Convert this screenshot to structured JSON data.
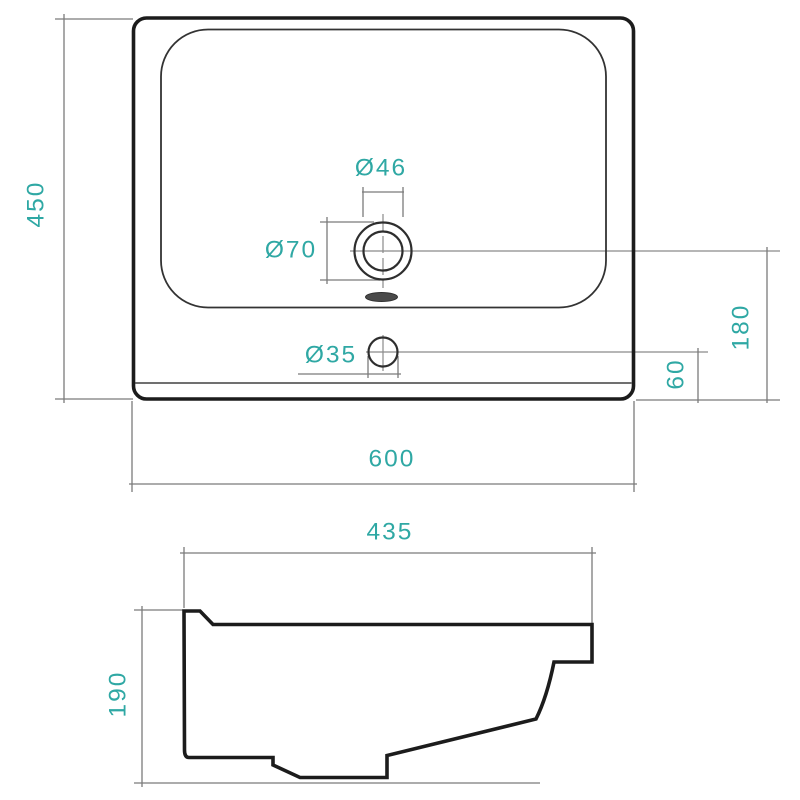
{
  "figure": {
    "type": "technical-drawing",
    "subject": "washbasin dimensional drawing, front view and side profile",
    "colors": {
      "dimension_text": "#2FA8A4",
      "outline": "#1C1C1C",
      "thin_lines": "#7B7B7B",
      "background": "#FFFFFF"
    },
    "front_view": {
      "overall_width": "600",
      "overall_depth": "450",
      "faucet_hole_diameter": "Ø46",
      "faucet_recess_diameter": "Ø70",
      "small_hole_diameter": "Ø35",
      "faucet_axis_to_front_edge": "180",
      "small_hole_axis_to_front_edge": "60"
    },
    "side_view": {
      "basin_depth": "435",
      "basin_height": "190"
    }
  }
}
